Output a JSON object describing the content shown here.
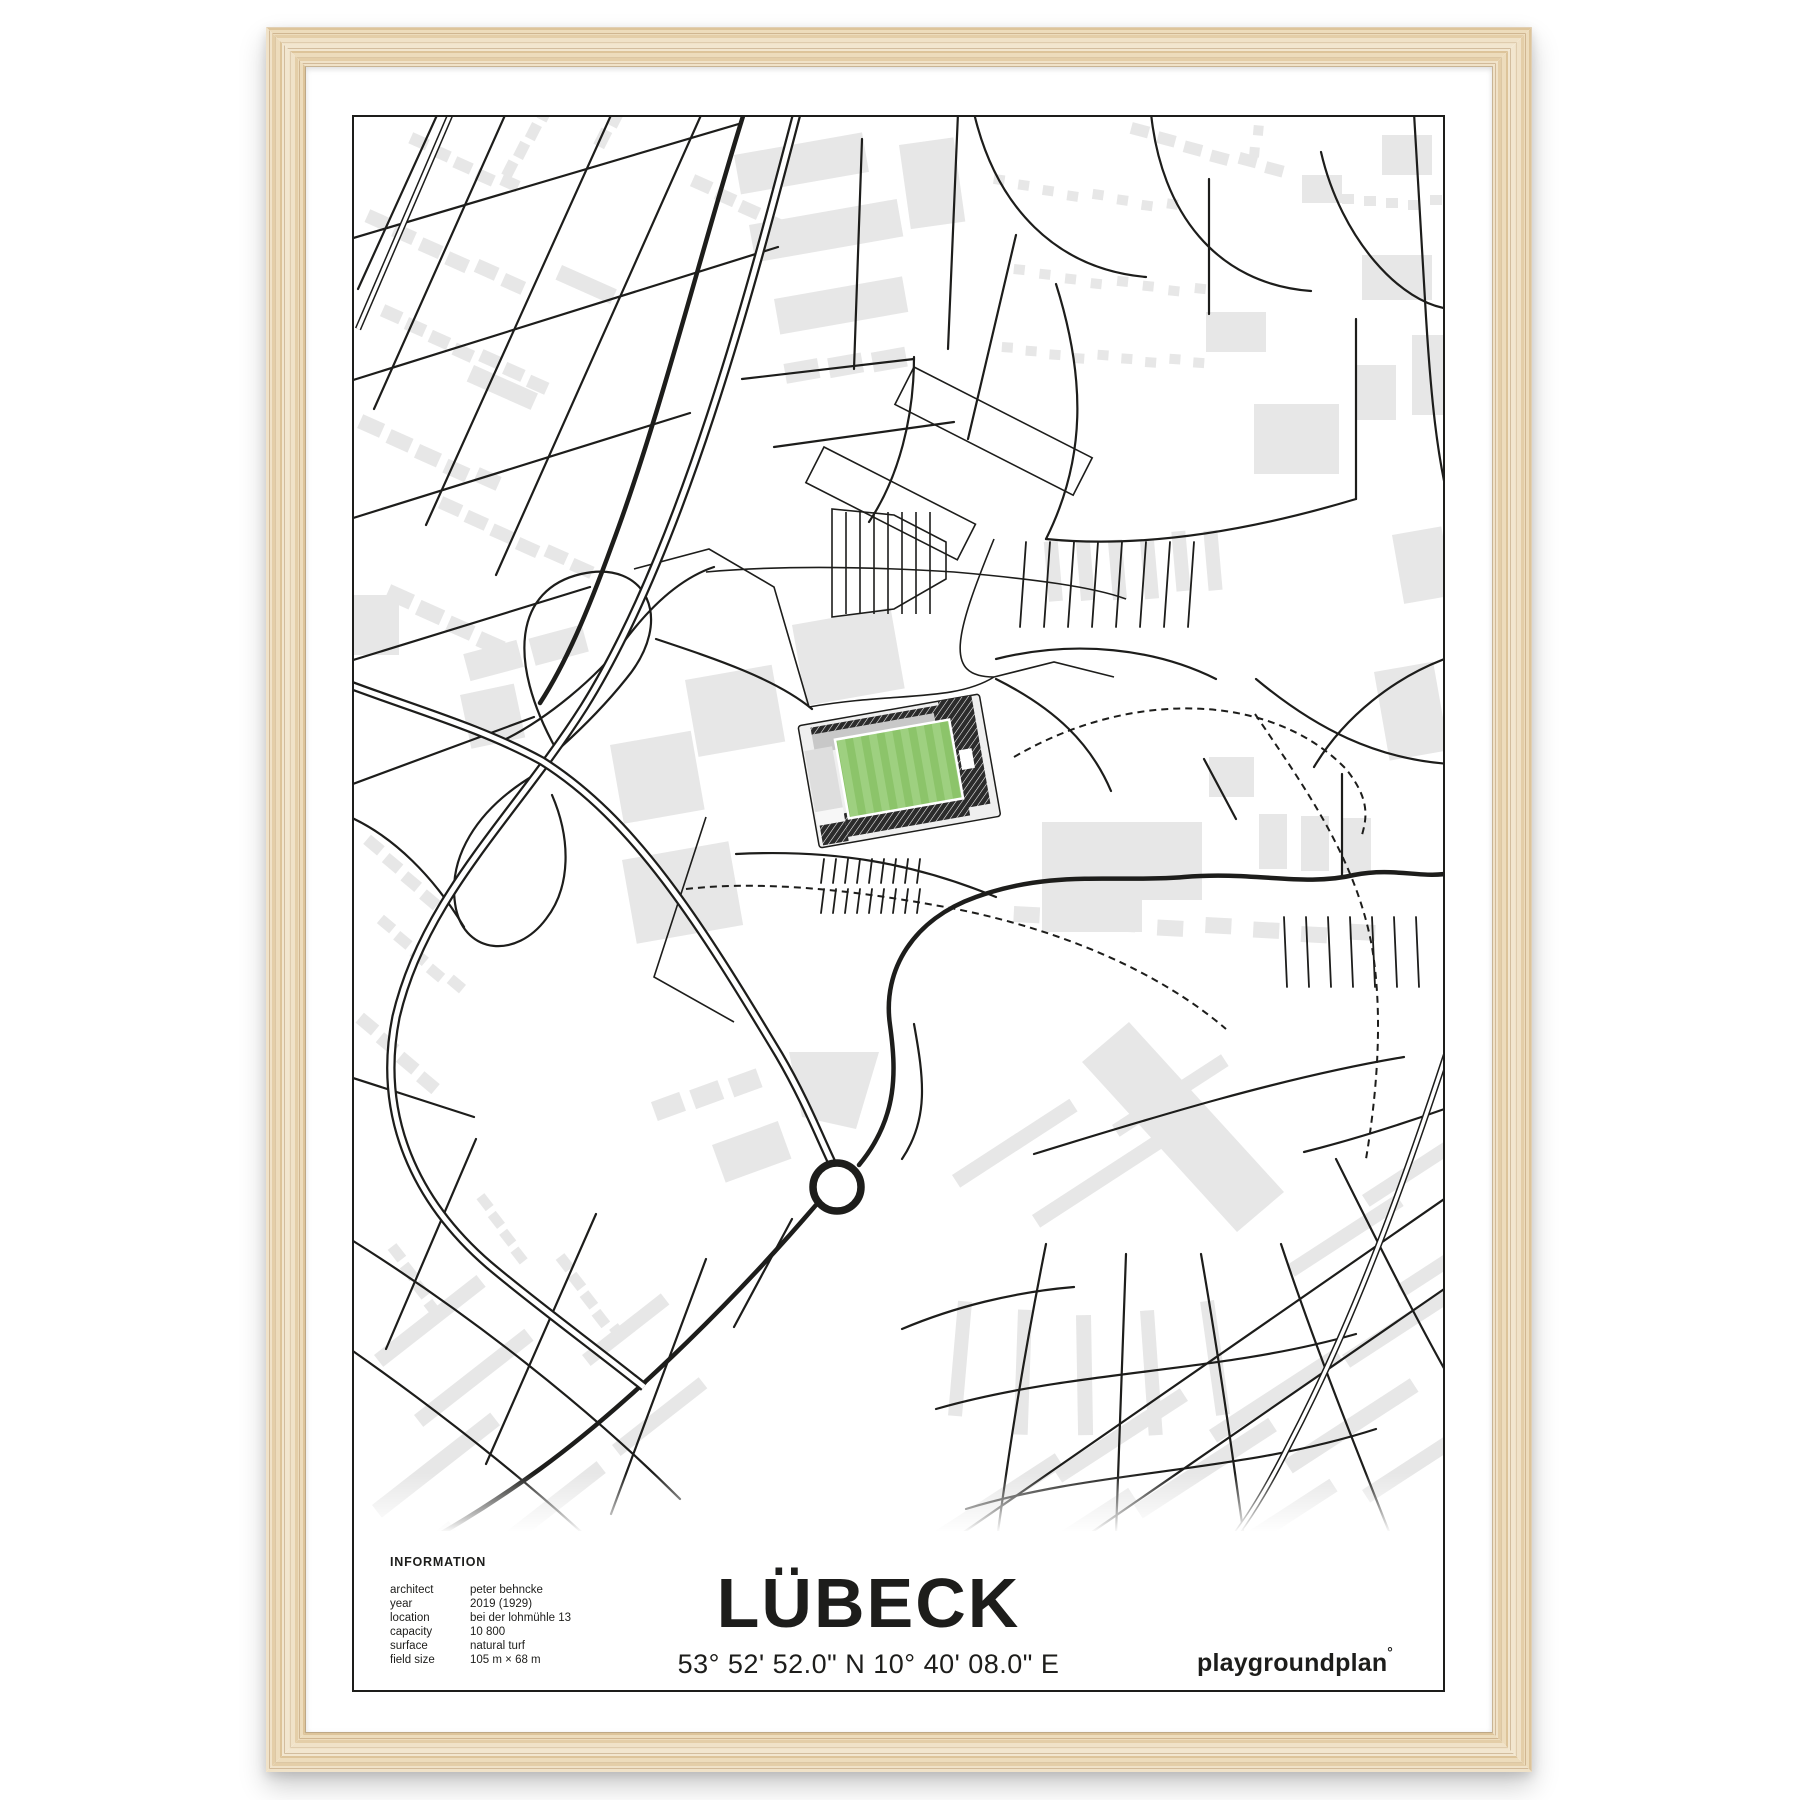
{
  "poster": {
    "title": "LÜBECK",
    "coordinates": "53° 52' 52.0\" N 10° 40' 08.0\" E",
    "brand": "playgroundplan",
    "brand_mark": "°",
    "info": {
      "heading": "INFORMATION",
      "rows": [
        {
          "label": "architect",
          "value": "peter behncke"
        },
        {
          "label": "year",
          "value": "2019 (1929)"
        },
        {
          "label": "location",
          "value": "bei der lohmühle 13"
        },
        {
          "label": "capacity",
          "value": "10 800"
        },
        {
          "label": "surface",
          "value": "natural turf"
        },
        {
          "label": "field size",
          "value": "105 m × 68 m"
        }
      ]
    }
  },
  "colors": {
    "ink": "#1d1d1b",
    "building": "#e7e7e7",
    "pitch_green_light": "#9ed080",
    "pitch_green_dark": "#8cc46a",
    "stand_dark": "#2b2b2b",
    "stand_gray": "#c8c8c8",
    "frame_wood": "#ecdcc0"
  }
}
